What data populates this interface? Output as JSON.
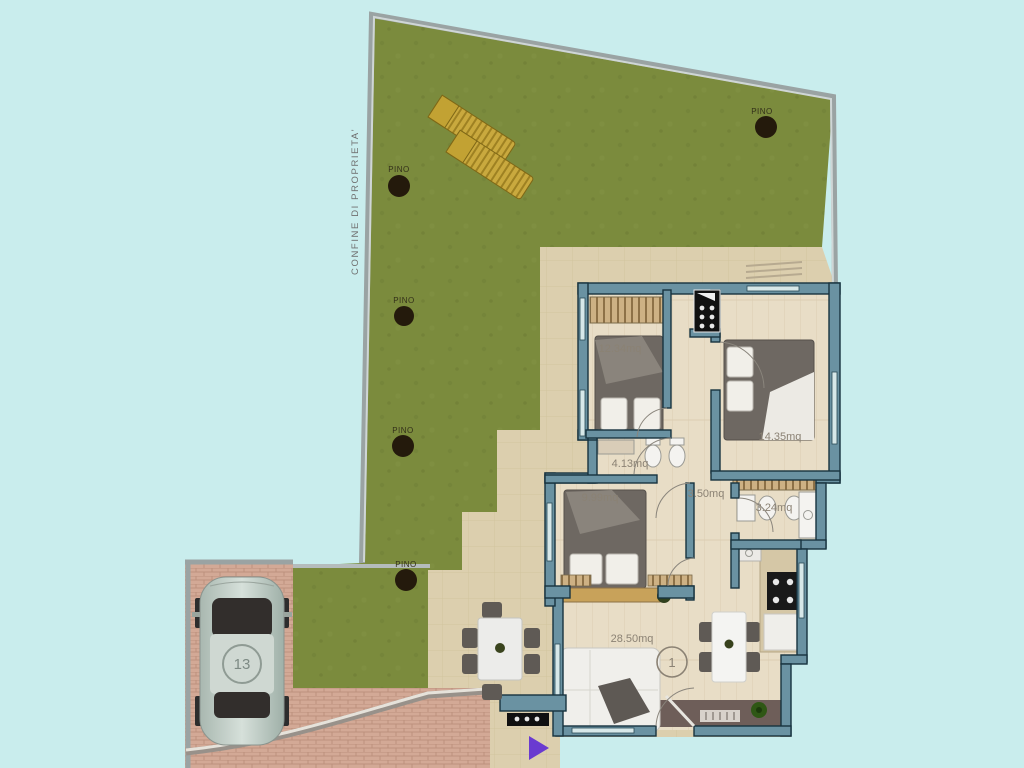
{
  "scene": {
    "background_color": "#c9eded",
    "boundary_label": "CONFINE DI PROPRIETA'",
    "garden": {
      "color": "#7b8b3d",
      "trees": [
        {
          "label": "PINO"
        },
        {
          "label": "PINO"
        },
        {
          "label": "PINO"
        },
        {
          "label": "PINO"
        },
        {
          "label": "PINO"
        }
      ],
      "loungers_count": 2
    },
    "apartment": {
      "unit_number": "1",
      "wall_color": "#6a92a2",
      "floor_color": "#e8ddc6",
      "rooms": [
        {
          "name": "bedroom-1",
          "area_label": "12.34mq"
        },
        {
          "name": "bathroom-1",
          "area_label": "4.13mq"
        },
        {
          "name": "bedroom-2",
          "area_label": "14.35mq"
        },
        {
          "name": "bedroom-3",
          "area_label": "9.99mq"
        },
        {
          "name": "hallway",
          "area_label": "3.50mq"
        },
        {
          "name": "bathroom-2",
          "area_label": "3.24mq"
        },
        {
          "name": "living-kitchen",
          "area_label": "28.50mq"
        }
      ]
    },
    "parking": {
      "car_number": "13",
      "pavement_color": "#d3a996"
    },
    "terrace_color": "#dccfae"
  }
}
